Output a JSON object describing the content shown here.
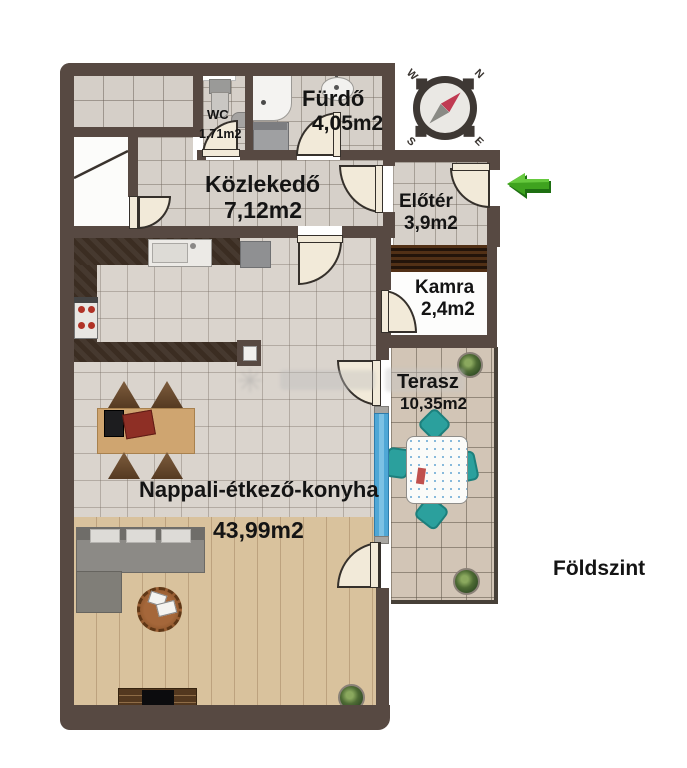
{
  "floor_plan": {
    "floor_label": "Földszint",
    "rooms": [
      {
        "name": "WC",
        "area": "1,71m2"
      },
      {
        "name": "Fürdő",
        "area": "4,05m2"
      },
      {
        "name": "Közlekedő",
        "area": "7,12m2"
      },
      {
        "name": "Előtér",
        "area": "3,9m2"
      },
      {
        "name": "Kamra",
        "area": "2,4m2"
      },
      {
        "name": "Terasz",
        "area": "10,35m2"
      },
      {
        "name": "Nappali-étkező-konyha",
        "area": "43,99m2"
      }
    ],
    "compass": {
      "n": "N",
      "e": "E",
      "s": "S",
      "w": "W"
    },
    "colors": {
      "wall": "#574942",
      "bath_tile": "#d6d0c9",
      "living_tile": "#dad4cd",
      "terrace_tile": "#d2c5b6",
      "wood_floor": "#d9c29d",
      "kitchen_counter": "#3b2d22",
      "door_leaf": "#f2ead9",
      "window_blue": "#4fa7d6",
      "entrance_arrow_green": "#3fa31f",
      "terrace_chair_teal": "#2ba09d"
    }
  }
}
